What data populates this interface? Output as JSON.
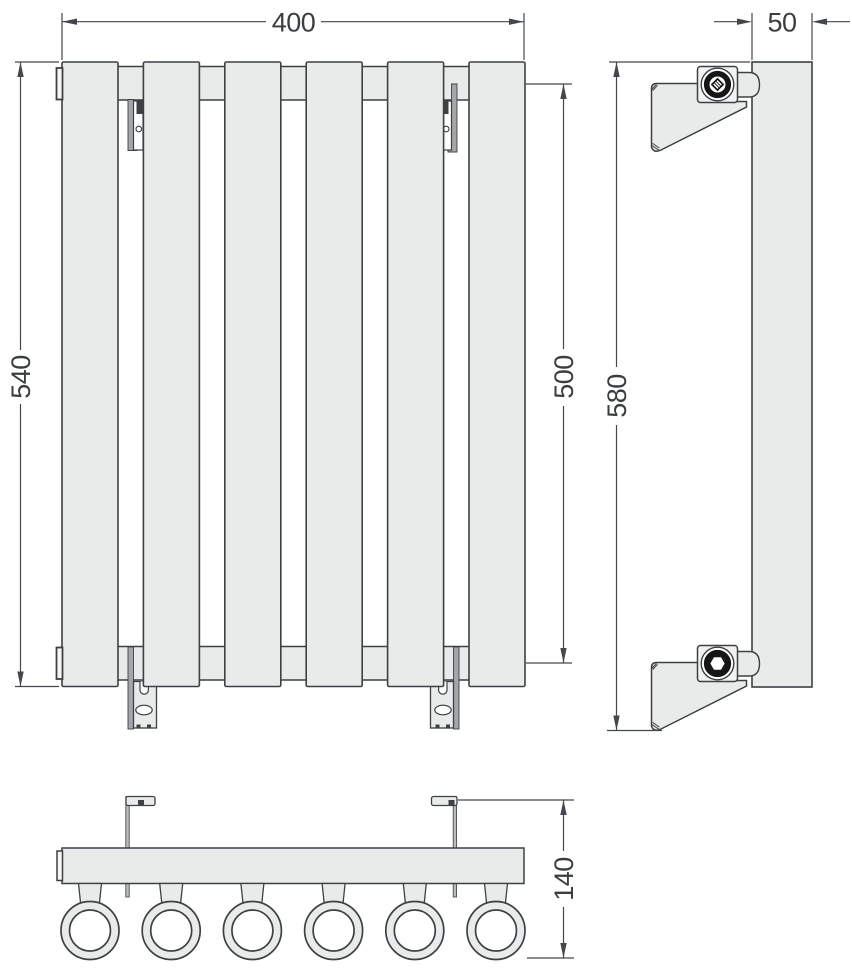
{
  "drawing": {
    "dimensions": {
      "width": "400",
      "height": "540",
      "port_spacing": "500",
      "depth": "50",
      "overall_height": "580",
      "overall_depth": "140"
    },
    "panel_count": 6,
    "tube_count": 6,
    "colors": {
      "background": "#ffffff",
      "body_fill": "#e9eaea",
      "outline": "#3d4144",
      "dimension_lines": "#44474b",
      "bracket_rail": "#a4a7a9",
      "bolt_ring": "#161616"
    }
  }
}
